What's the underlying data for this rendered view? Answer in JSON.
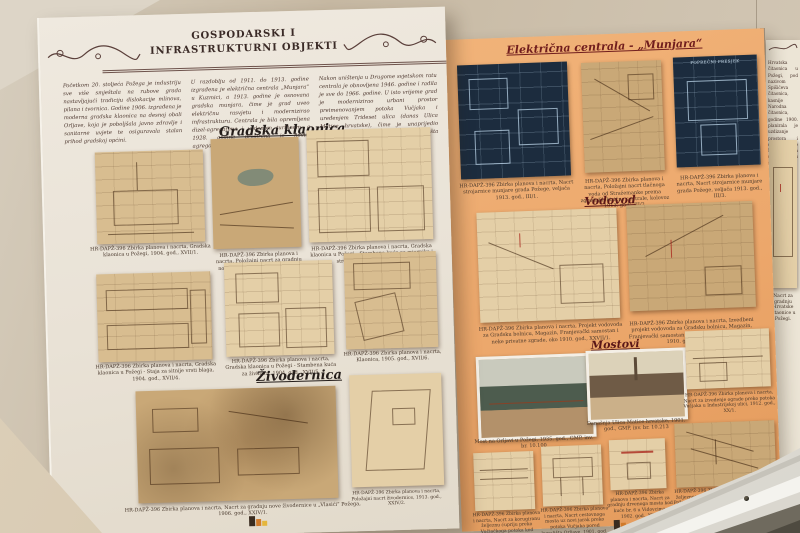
{
  "palette": {
    "wall": "#cdc1ae",
    "panel_white": "#eae3d8",
    "panel_orange": "#eca76b",
    "blueprint": "#1c2c3e",
    "sepia_paper": "#d8bd90",
    "title_ink": "#3a2a26",
    "accent_red": "#701d1d"
  },
  "icons": {
    "flourish_left": "vine-flourish",
    "flourish_right": "vine-flourish",
    "museum_logo": "gmp-emblem"
  },
  "left": {
    "title1": "GOSPODARSKI I",
    "title2": "INFRASTRUKTURNI OBJEKTI",
    "intro_col1": "Početkom 20. stoljeća Požega je industriju sve više smještala na rubove grada nastavljajući tradiciju dislokacije mlinova, pilana i tvornica. Godine 1906. izgrađena je moderna gradska klaonica na desnoj obali Orljave, koja je poboljšala javno zdravlje i sanitarne uvjete te osiguravala stalan prihod gradskoj općini.",
    "intro_col2": "U razdoblju od 1911. do 1913. godine izgrađena je električna centrala „Munjara“ u Kuzmici, a 1913. godine je osnovana gradska munjara, čime je grad uveo električnu rasvjetu i modernizirao infrastrukturu. Centrala je bila opremljena dizel-agregatima i vodenom turbinom, a 1928. godine proširena je novim agregatom.",
    "intro_col3": "Nakon uništenja u Drugome svjetskom ratu centrala je obnovljena 1946. godine i radila je sve do 1966. godine. U isto vrijeme grad je modernizirao urbani prostor preimenovanjem potoka Vučjaka i uređenjem Trideset ulica (danas Ulica Matice hrvatske), čime je unaprijedio kvalitetu prometovanja i izgled središta grada.",
    "section_klaonica": "Gradska klaonica",
    "section_zivodernica": "Živodernica",
    "captions_row1": [
      "HR-DAPŽ-396 Zbirka planova i nacrta, Gradska klaonica u Požegi, 1904. god., XVII/1.",
      "HR-DAPŽ-396 Zbirka planova i nacrta, Položajni nacrt za gradnju nove „Klaonice“ u gradu Požegi, 1903. god., XVII/2.",
      "HR-DAPŽ-396 Zbirka planova i nacrta, Gradska klaonica u Požegi - Stambena kuća za mjernika i strojara, 1904. god., XVII/3."
    ],
    "captions_row2": [
      "HR-DAPŽ-396 Zbirka planova i nacrta, Gradska klaonica u Požegi - Staja za sitnije vrsti blaga, 1904. god., XVII/4.",
      "HR-DAPŽ-396 Zbirka planova i nacrta, Gradska klaonica u Požegi - Stambena kuća za živinara, 1904. god., XVII/5.",
      "HR-DAPŽ-396 Zbirka planova i nacrta, Klaonica, 1905. god., XVII/6."
    ],
    "captions_zivodernica": [
      "HR-DAPŽ-396 Zbirka planova i nacrta, Nacrt za gradnju nove živodernice u „Vlasići“ Požega, 1906. god., XXIV/1.",
      "HR-DAPŽ-396 Zbirka planova i nacrta, Položajni nacrt živodernice, 1913. god., XXIV/2."
    ]
  },
  "right": {
    "section_munjara": "Električna centrala - „Munjara“",
    "section_vodovod": "Vodovod",
    "section_mostovi": "Mostovi",
    "blueprint2_label": "POPREČNI PRESJEK",
    "captions_munjara": [
      "HR-DAPŽ-396 Zbirka planova i nacrta, Nacrt strojarnice munjare grada Požege, veljača 1913. god., III/1.",
      "HR-DAPŽ-396 Zbirka planova i nacrta, Položajni nacrt tlačnoga voda od Stražemanke prema zgradi Električne centrale, kolovoz 1913. god., III/2.",
      "HR-DAPŽ-396 Zbirka planova i nacrta, Nacrt strojarnice munjare grada Požege, veljača 1913. god., III/3."
    ],
    "captions_vodovod": [
      "HR-DAPŽ-396 Zbirka planova i nacrta, Projekt vodovoda za Gradsku bolnicu, Magazin, Franjevački samostan i neke privatne zgrade, oko 1910. god., XXVII/1.",
      "HR-DAPŽ-396 Zbirka planova i nacrta, Izvedbeni projekt vodovoda za Gradsku bolnicu, Magazin, Franjevački samostan i neke privatne zgrade, oko 1910. god., XXVII/2."
    ],
    "captions_mostovi": [
      "Most na Orljavi u Požegi, 1935. god., GMP, inv. br. 10.100",
      "Današnja Ulica Matice hrvatske, 1901. god., GMP, inv. br. 10.213",
      "HR-DAPŽ-396 Zbirka planova i nacrta, Nacrt za izvedenje ograde preko potoka Vučjaka u Industrijskoj ulici, 1912. god., XX/1."
    ],
    "captions_bridges": [
      "HR-DAPŽ-396 Zbirka planova i nacrta, Nacrt za korugiranu željeznu ćupriju preko Vučjačkoga potoka kod Gimnazijskog druma, 1911. god., XX/2.",
      "HR-DAPŽ-396 Zbirka planova i nacrta, Nacrt cestovnoga mosta uz novi jarak preko potoka Vučjaka pored kupališta Orljave, 1901. god., XX/3.",
      "HR-DAPŽ-396 Zbirka planova i nacrta, Nacrt za gradnju drvenoga mosta kod kuće br. 6 u Vidovcima, 1902. god., XX/5.",
      "HR-DAPŽ-396 Zbirka planova i nacrta, Nacrt željeznoga mosta preko potoka Vučjaka kod Požege - most u Jagodnjaku, 1912. god., XX/6."
    ]
  },
  "far_right": {
    "text": "Hrvatska čitaonica u Požegi, pod nazivom Spišićeva čitaonica, kasnije Narodna čitaonica, godine 1900. planirala je uzdizanje prostora i dovršaj Ulice Matije Gupca uz zgradu Gradskog muzeja.",
    "caption": "Nacrt za gradnju Hrvatske čitaonice u Požegi."
  }
}
